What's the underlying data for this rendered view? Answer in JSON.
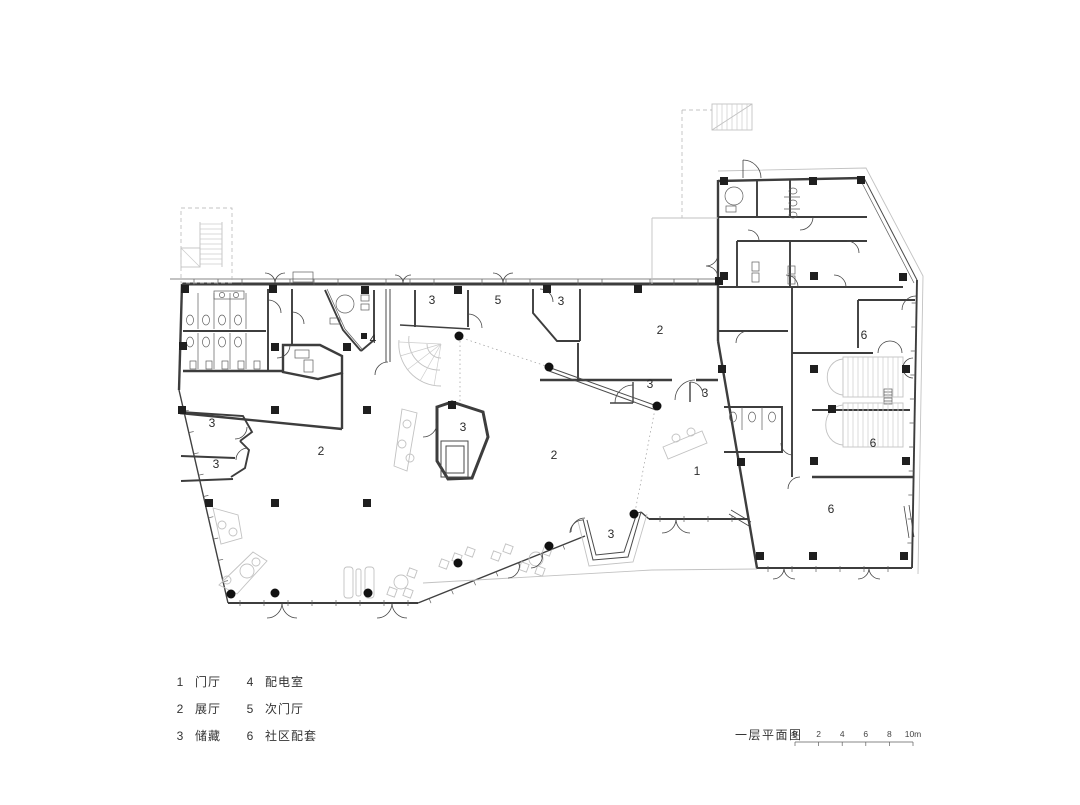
{
  "title": {
    "text": "一层平面图"
  },
  "scale_bar": {
    "labels": [
      "0",
      "2",
      "4",
      "6",
      "8",
      "10m"
    ]
  },
  "legend": {
    "items": [
      {
        "num": "1",
        "label": "门厅"
      },
      {
        "num": "2",
        "label": "展厅"
      },
      {
        "num": "3",
        "label": "储藏"
      },
      {
        "num": "4",
        "label": "配电室"
      },
      {
        "num": "5",
        "label": "次门厅"
      },
      {
        "num": "6",
        "label": "社区配套"
      }
    ]
  },
  "plan": {
    "room_labels": [
      {
        "text": "3",
        "x": 432,
        "y": 304
      },
      {
        "text": "5",
        "x": 498,
        "y": 304
      },
      {
        "text": "3",
        "x": 561,
        "y": 305
      },
      {
        "text": "2",
        "x": 660,
        "y": 334
      },
      {
        "text": "4",
        "x": 373,
        "y": 343
      },
      {
        "text": "3",
        "x": 650,
        "y": 388
      },
      {
        "text": "3",
        "x": 705,
        "y": 397
      },
      {
        "text": "3",
        "x": 212,
        "y": 427
      },
      {
        "text": "3",
        "x": 216,
        "y": 468
      },
      {
        "text": "3",
        "x": 463,
        "y": 431
      },
      {
        "text": "2",
        "x": 321,
        "y": 455
      },
      {
        "text": "2",
        "x": 554,
        "y": 459
      },
      {
        "text": "1",
        "x": 697,
        "y": 475
      },
      {
        "text": "3",
        "x": 611,
        "y": 538
      },
      {
        "text": "6",
        "x": 864,
        "y": 339
      },
      {
        "text": "6",
        "x": 873,
        "y": 447
      },
      {
        "text": "6",
        "x": 831,
        "y": 513
      }
    ]
  },
  "colors": {
    "wall": "#3d3d3d",
    "light": "#c2c2c2",
    "text": "#2b2b2b"
  }
}
